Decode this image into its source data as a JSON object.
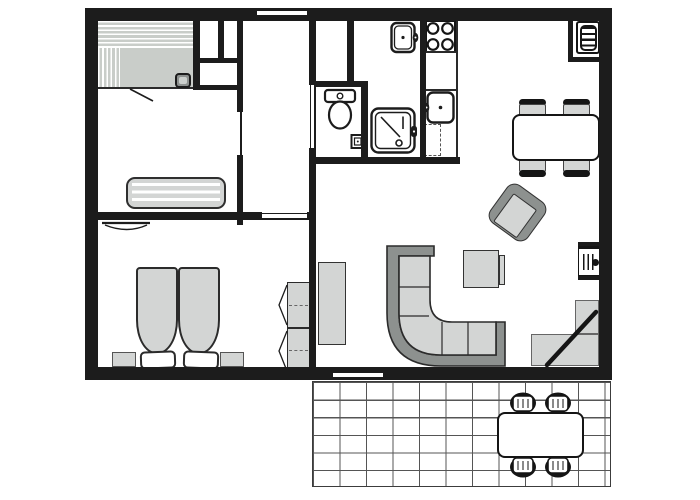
{
  "meta": {
    "kind": "floor-plan",
    "width_px": 700,
    "height_px": 500,
    "visible_text": ""
  },
  "colors": {
    "wall": "#1c1c1c",
    "light": "#d3d5d4",
    "dark": "#8d918f",
    "sauna": "#c9cdc9",
    "grid": "#555555",
    "line": "#2b2b2b",
    "background": "#ffffff"
  },
  "legend": {
    "rooms": [
      "sauna",
      "bedroom-1",
      "bedroom-2",
      "hallway",
      "toilet-room",
      "shower-room",
      "kitchen",
      "living-dining-room",
      "terrace"
    ],
    "fixtures": [
      "sauna-benches",
      "sauna-heater",
      "closets",
      "single-bed",
      "double-bed",
      "pillows",
      "nightstands",
      "wardrobe",
      "toilet",
      "toilet-paper-holder",
      "shower",
      "washbasin",
      "stove-4-burners",
      "kitchen-sink",
      "dishwasher",
      "fireplace-stove",
      "dining-table",
      "dining-chairs",
      "armchair",
      "coffee-table",
      "corner-sofa",
      "sideboard",
      "tv-stand",
      "entrance-platform",
      "entrance-door",
      "terrace-tiles",
      "outdoor-table",
      "outdoor-chairs"
    ],
    "windows": [
      "top-wall-window",
      "bottom-wall-window"
    ]
  }
}
